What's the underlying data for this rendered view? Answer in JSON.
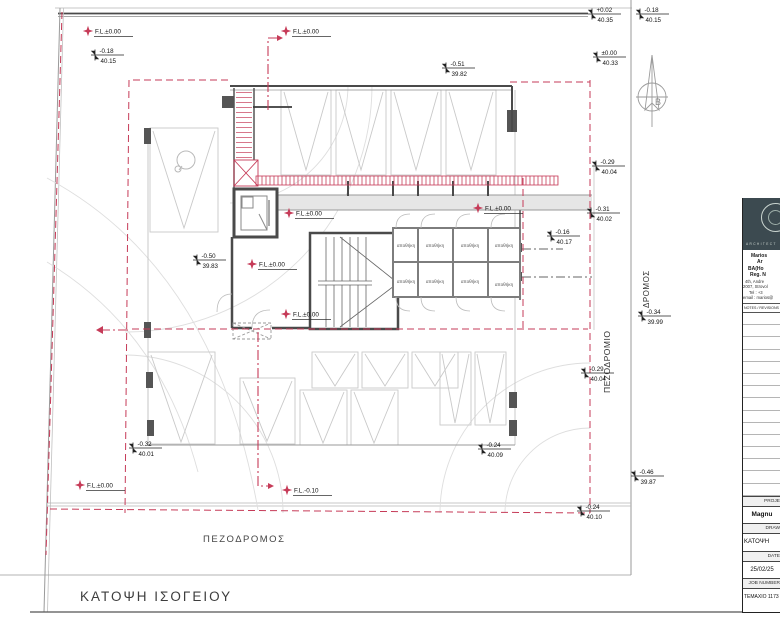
{
  "plan": {
    "title": "ΚΑΤΟΨΗ ΙΣΟΓΕΙΟΥ",
    "labels": {
      "pedestrian_street_bottom": "ΠΕΖΟΔΡΟΜΟΣ",
      "sidewalk_vertical": "ΠΕΖΟΔΡΟΜΙΟ",
      "road_vertical": "ΔΡΟΜΟΣ",
      "north": "B",
      "storage_room": "αποθήκη"
    },
    "colors": {
      "red": "#c63b58",
      "wall_dark": "#4a4a4a",
      "wall_mid": "#8a8a8a",
      "line_light": "#c4c4c4",
      "arc_faint": "#dedede",
      "band_fill": "#e6e6e6"
    },
    "level_markers": [
      {
        "value": "-0.18",
        "altitude": "40.15",
        "x": 95,
        "y": 55
      },
      {
        "value": "+0.02",
        "altitude": "40.35",
        "x": 592,
        "y": 14
      },
      {
        "value": "-0.18",
        "altitude": "40.15",
        "x": 640,
        "y": 14
      },
      {
        "value": "±0.00",
        "altitude": "40.33",
        "x": 597,
        "y": 57
      },
      {
        "value": "-0.51",
        "altitude": "39.82",
        "x": 446,
        "y": 68
      },
      {
        "value": "-0.50",
        "altitude": "39.83",
        "x": 197,
        "y": 260
      },
      {
        "value": "-0.16",
        "altitude": "40.17",
        "x": 551,
        "y": 236
      },
      {
        "value": "-0.29",
        "altitude": "40.04",
        "x": 596,
        "y": 166
      },
      {
        "value": "-0.31",
        "altitude": "40.02",
        "x": 591,
        "y": 213
      },
      {
        "value": "-0.29",
        "altitude": "40.04",
        "x": 585,
        "y": 373
      },
      {
        "value": "-0.34",
        "altitude": "39.99",
        "x": 642,
        "y": 316
      },
      {
        "value": "-0.46",
        "altitude": "39.87",
        "x": 635,
        "y": 476
      },
      {
        "value": "-0.32",
        "altitude": "40.01",
        "x": 133,
        "y": 448
      },
      {
        "value": "-0.24",
        "altitude": "40.09",
        "x": 482,
        "y": 449
      },
      {
        "value": "-0.24",
        "altitude": "40.10",
        "x": 581,
        "y": 511
      }
    ],
    "fl_markers": [
      {
        "label": "F.L.±0.00",
        "x": 88,
        "y": 31
      },
      {
        "label": "F.L.±0.00",
        "x": 286,
        "y": 31
      },
      {
        "label": "F.L.±0.00",
        "x": 478,
        "y": 208
      },
      {
        "label": "F.L.±0.00",
        "x": 289,
        "y": 213
      },
      {
        "label": "F.L.±0.00",
        "x": 252,
        "y": 264
      },
      {
        "label": "F.L.±0.00",
        "x": 286,
        "y": 314
      },
      {
        "label": "F.L.±0.00",
        "x": 80,
        "y": 485
      },
      {
        "label": "F.L.-0.10",
        "x": 287,
        "y": 490
      }
    ]
  },
  "title_block": {
    "logo_caption": "ARCHITECT",
    "firm_lines": [
      "Marios",
      "Ar",
      "BA(Ho",
      "Reg. N",
      "4th, Andre",
      "2007, Strovol",
      "Tel : +3",
      "email : marios@"
    ],
    "notes_header": "NOTES / REVISIONS",
    "fields": [
      {
        "label": "PROJE",
        "value": "Magnu"
      },
      {
        "label": "DRAW",
        "value": "ΚΑΤΟΨΗ"
      },
      {
        "label": "DATE",
        "value": "25/02/25"
      },
      {
        "label": "JOB NUMBER",
        "value": "ΤΕΜΑΧΙΟ 1173"
      }
    ]
  }
}
